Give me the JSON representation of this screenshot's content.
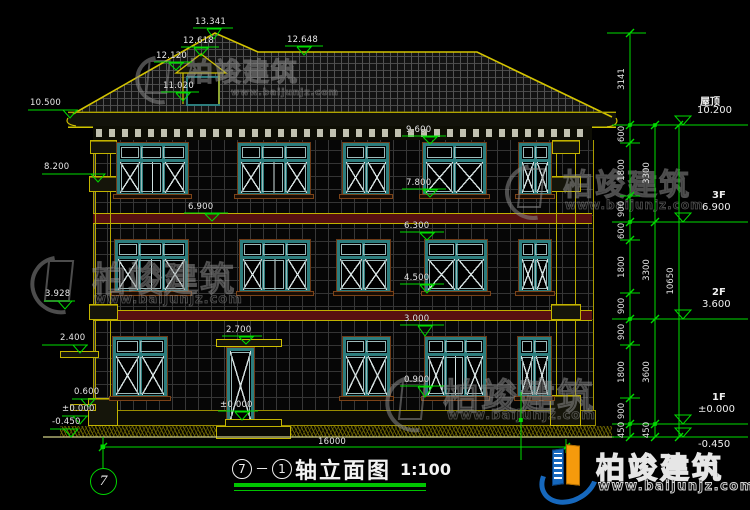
{
  "title": {
    "axis_a": "7",
    "dash": "－",
    "axis_b": "1",
    "name": "轴立面图",
    "scale": "1:100"
  },
  "axis_bubble": "7",
  "total_width": "16000",
  "levels_right": [
    {
      "name": "屋顶",
      "value": "10.200"
    },
    {
      "name": "3F",
      "value": "6.900"
    },
    {
      "name": "2F",
      "value": "3.600"
    },
    {
      "name": "1F",
      "value": "±0.000"
    },
    {
      "name": "",
      "value": "-0.450"
    }
  ],
  "labels_left": [
    "10.500",
    "8.200",
    "3.928",
    "2.400",
    "0.600",
    "±0.000",
    "-0.450"
  ],
  "labels_top": [
    "13.341",
    "12.618",
    "12.120",
    "11.020",
    "12.648"
  ],
  "labels_interior": [
    "9.600",
    "7.800",
    "6.900",
    "6.300",
    "4.500",
    "3.000",
    "2.700",
    "0.900",
    "±0.000"
  ],
  "chain_inner": [
    "3141",
    "600",
    "1800",
    "900",
    "600",
    "1800",
    "900",
    "900",
    "1800",
    "900",
    "450"
  ],
  "chain_mid": [
    "3300",
    "3300",
    "3600",
    "450"
  ],
  "chain_outer": [
    "10650"
  ],
  "watermark": {
    "brand": "柏竣建筑",
    "url": "www.baijunjz.com"
  }
}
